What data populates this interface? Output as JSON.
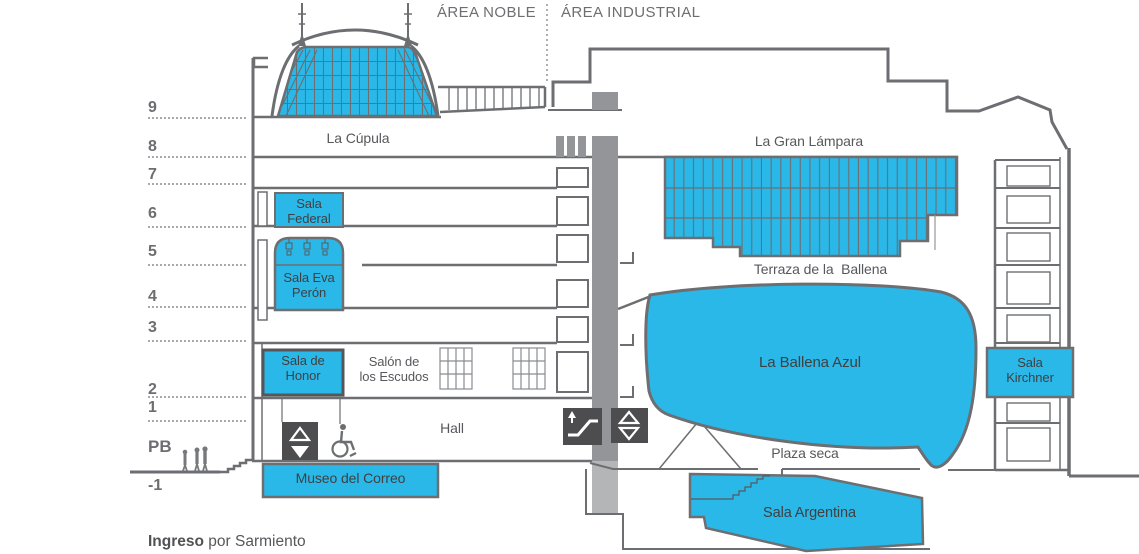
{
  "areas": {
    "noble": "ÁREA NOBLE",
    "industrial": "ÁREA INDUSTRIAL"
  },
  "floors": [
    {
      "label": "9"
    },
    {
      "label": "8"
    },
    {
      "label": "7"
    },
    {
      "label": "6"
    },
    {
      "label": "5"
    },
    {
      "label": "4"
    },
    {
      "label": "3"
    },
    {
      "label": "2"
    },
    {
      "label": "1"
    },
    {
      "label": "PB"
    },
    {
      "label": "-1"
    }
  ],
  "rooms": {
    "cupula": {
      "label": "La Cúpula"
    },
    "gran_lampara": {
      "label": "La Gran Lámpara"
    },
    "terraza": {
      "label": "Terraza de la  Ballena"
    },
    "sala_federal": {
      "label": "Sala\nFederal"
    },
    "sala_eva_peron": {
      "label": "Sala Eva\nPerón"
    },
    "sala_de_honor": {
      "label": "Sala de\nHonor"
    },
    "salon_escudos": {
      "label": "Salón de\nlos Escudos"
    },
    "hall": {
      "label": "Hall"
    },
    "museo_correo": {
      "label": "Museo del Correo"
    },
    "ballena_azul": {
      "label": "La Ballena Azul"
    },
    "plaza_seca": {
      "label": "Plaza seca"
    },
    "sala_kirchner": {
      "label": "Sala\nKirchner"
    },
    "sala_argentina": {
      "label": "Sala Argentina"
    }
  },
  "entrance": {
    "bold": "Ingreso",
    "rest": " por Sarmiento"
  },
  "icons": {
    "elevator": "up-down-triangles",
    "escalator": "escalator-with-up-arrow",
    "wheelchair": "wheelchair-accessibility",
    "people": "people-silhouettes"
  },
  "colors": {
    "accent_cyan": "#2AB8E8",
    "outline_gray": "#6D6E71",
    "icon_dark": "#4D4D4F",
    "shaft_gray": "#939598"
  }
}
